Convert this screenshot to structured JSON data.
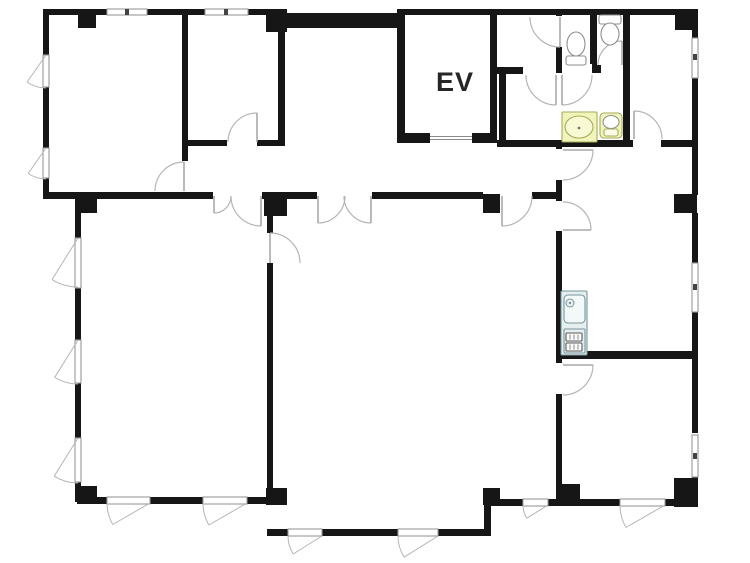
{
  "label": {
    "text": "EV"
  },
  "colors": {
    "background": "#ffffff",
    "wall": "#161616",
    "arc": "#b5b5b5",
    "leaf": "#a8a8a8",
    "glass": "#999999",
    "tick": "#444444",
    "fixture_stroke": "#8f8f8f",
    "fixture_fill": "#ffffff",
    "yellow_fill": "#f2f5ba",
    "yellow_stroke": "#a6aa5e",
    "yellow_bowl": "#f7fad2",
    "kitchen_fill": "#e6efef",
    "kitchen_stroke": "#76969c",
    "label": "#262626",
    "ev_door": "#8a8a8a"
  },
  "walls": [
    [
      43,
      9,
      64,
      6
    ],
    [
      147,
      9,
      40,
      6
    ],
    [
      43,
      9,
      6,
      46
    ],
    [
      43,
      87,
      6,
      61
    ],
    [
      43,
      178,
      6,
      19
    ],
    [
      182,
      9,
      6,
      152
    ],
    [
      187,
      9,
      18,
      6
    ],
    [
      248,
      9,
      22,
      6
    ],
    [
      283,
      13,
      122,
      15
    ],
    [
      278,
      28,
      7,
      117
    ],
    [
      187,
      140,
      40,
      6
    ],
    [
      257,
      140,
      28,
      6
    ],
    [
      397,
      9,
      95,
      6
    ],
    [
      397,
      13,
      8,
      130
    ],
    [
      490,
      9,
      7,
      134
    ],
    [
      397,
      133,
      33,
      10
    ],
    [
      472,
      133,
      25,
      10
    ],
    [
      490,
      9,
      207,
      6
    ],
    [
      499,
      67,
      7,
      76
    ],
    [
      490,
      67,
      33,
      7
    ],
    [
      556,
      9,
      6,
      7
    ],
    [
      556,
      47,
      6,
      20
    ],
    [
      590,
      15,
      7,
      50
    ],
    [
      623,
      15,
      7,
      128
    ],
    [
      556,
      65,
      6,
      8
    ],
    [
      592,
      65,
      9,
      8
    ],
    [
      623,
      65,
      7,
      8
    ],
    [
      497,
      140,
      133,
      7
    ],
    [
      630,
      140,
      3,
      7
    ],
    [
      661,
      140,
      36,
      7
    ],
    [
      692,
      9,
      6,
      29
    ],
    [
      692,
      78,
      6,
      117
    ],
    [
      692,
      213,
      6,
      50
    ],
    [
      692,
      312,
      6,
      121
    ],
    [
      692,
      477,
      6,
      30
    ],
    [
      43,
      192,
      170,
      7
    ],
    [
      262,
      192,
      55,
      7
    ],
    [
      372,
      192,
      111,
      7
    ],
    [
      532,
      192,
      30,
      7
    ],
    [
      556,
      143,
      6,
      7
    ],
    [
      556,
      180,
      6,
      21
    ],
    [
      556,
      231,
      6,
      133
    ],
    [
      556,
      394,
      6,
      107
    ],
    [
      562,
      351,
      130,
      8
    ],
    [
      75,
      197,
      6,
      41
    ],
    [
      75,
      288,
      6,
      52
    ],
    [
      75,
      383,
      6,
      55
    ],
    [
      75,
      482,
      6,
      20
    ],
    [
      77,
      497,
      30,
      7
    ],
    [
      150,
      497,
      53,
      7
    ],
    [
      247,
      497,
      23,
      7
    ],
    [
      267,
      213,
      6,
      20
    ],
    [
      267,
      263,
      6,
      238
    ],
    [
      267,
      529,
      21,
      7
    ],
    [
      322,
      529,
      76,
      7
    ],
    [
      438,
      529,
      53,
      7
    ],
    [
      484,
      504,
      7,
      30
    ],
    [
      491,
      499,
      32,
      7
    ],
    [
      548,
      499,
      72,
      7
    ],
    [
      665,
      499,
      32,
      7
    ]
  ],
  "pillars": [
    [
      78,
      9,
      18,
      19
    ],
    [
      266,
      9,
      21,
      23
    ],
    [
      675,
      12,
      22,
      18
    ],
    [
      77,
      197,
      20,
      16
    ],
    [
      264,
      194,
      23,
      22
    ],
    [
      483,
      194,
      17,
      19
    ],
    [
      674,
      194,
      23,
      19
    ],
    [
      77,
      486,
      20,
      18
    ],
    [
      266,
      488,
      21,
      17
    ],
    [
      483,
      488,
      17,
      17
    ],
    [
      560,
      484,
      20,
      17
    ],
    [
      674,
      478,
      23,
      29
    ]
  ],
  "openings": [
    [
      181,
      161,
      8,
      30
    ],
    [
      227,
      139,
      30,
      7
    ],
    [
      555,
      16,
      8,
      31
    ],
    [
      523,
      66,
      33,
      9
    ],
    [
      562,
      64,
      30,
      10
    ],
    [
      601,
      64,
      22,
      10
    ],
    [
      633,
      139,
      28,
      9
    ],
    [
      500,
      192,
      32,
      7
    ],
    [
      317,
      192,
      55,
      7
    ],
    [
      213,
      192,
      49,
      7
    ],
    [
      266,
      233,
      8,
      30
    ],
    [
      555,
      149,
      8,
      31
    ],
    [
      555,
      201,
      8,
      30
    ],
    [
      555,
      363,
      8,
      31
    ]
  ],
  "glass": [
    [
      107,
      9,
      40,
      6
    ],
    [
      205,
      9,
      43,
      6
    ],
    [
      692,
      38,
      6,
      40
    ],
    [
      692,
      263,
      6,
      49
    ],
    [
      692,
      435,
      6,
      42
    ],
    [
      43,
      55,
      6,
      32
    ],
    [
      43,
      148,
      6,
      30
    ],
    [
      75,
      238,
      6,
      50
    ],
    [
      75,
      340,
      6,
      43
    ],
    [
      75,
      438,
      6,
      44
    ],
    [
      107,
      497,
      43,
      7
    ],
    [
      203,
      497,
      44,
      7
    ],
    [
      288,
      529,
      34,
      7
    ],
    [
      398,
      529,
      40,
      7
    ],
    [
      523,
      499,
      25,
      7
    ],
    [
      620,
      499,
      45,
      7
    ]
  ],
  "ticks": [
    [
      127,
      12
    ],
    [
      226,
      12
    ],
    [
      695,
      57
    ],
    [
      695,
      287
    ],
    [
      695,
      456
    ]
  ],
  "doors": [
    {
      "h": [
        184,
        191
      ],
      "r": 29,
      "a0": 270,
      "a1": 180,
      "s": 0
    },
    {
      "h": [
        257,
        142
      ],
      "r": 29,
      "a0": 270,
      "a1": 180,
      "s": 0
    },
    {
      "h": [
        560,
        17
      ],
      "r": 30,
      "a0": 90,
      "a1": 180,
      "s": 1
    },
    {
      "h": [
        556,
        75
      ],
      "r": 30,
      "a0": 90,
      "a1": 180,
      "s": 1
    },
    {
      "h": [
        562,
        75
      ],
      "r": 30,
      "a0": 90,
      "a1": 0,
      "s": 0
    },
    {
      "h": [
        622,
        65
      ],
      "r": 24,
      "a0": 270,
      "a1": 180,
      "s": 0
    },
    {
      "h": [
        634,
        139
      ],
      "r": 28,
      "a0": 270,
      "a1": 360,
      "s": 1
    },
    {
      "h": [
        502,
        196
      ],
      "r": 30,
      "a0": 90,
      "a1": 0,
      "s": 0
    },
    {
      "h": [
        318,
        196
      ],
      "r": 27,
      "a0": 90,
      "a1": 0,
      "s": 0
    },
    {
      "h": [
        371,
        196
      ],
      "r": 27,
      "a0": 90,
      "a1": 180,
      "s": 1
    },
    {
      "h": [
        214,
        196
      ],
      "r": 17,
      "a0": 90,
      "a1": 0,
      "s": 0
    },
    {
      "h": [
        261,
        196
      ],
      "r": 30,
      "a0": 90,
      "a1": 180,
      "s": 1
    },
    {
      "h": [
        270,
        263
      ],
      "r": 30,
      "a0": 270,
      "a1": 360,
      "s": 1
    },
    {
      "h": [
        563,
        150
      ],
      "r": 30,
      "a0": 0,
      "a1": 90,
      "s": 1
    },
    {
      "h": [
        563,
        230
      ],
      "r": 28,
      "a0": 0,
      "a1": 270,
      "s": 0
    },
    {
      "h": [
        563,
        365
      ],
      "r": 30,
      "a0": 0,
      "a1": 90,
      "s": 1
    }
  ],
  "fans": [
    {
      "p": [
        46,
        55
      ],
      "len": 33,
      "a0": 90,
      "a1": 125,
      "s": 1
    },
    {
      "p": [
        46,
        148
      ],
      "len": 31,
      "a0": 90,
      "a1": 125,
      "s": 1
    },
    {
      "p": [
        78,
        238
      ],
      "len": 49,
      "a0": 90,
      "a1": 122,
      "s": 1
    },
    {
      "p": [
        78,
        340
      ],
      "len": 44,
      "a0": 90,
      "a1": 122,
      "s": 1
    },
    {
      "p": [
        78,
        438
      ],
      "len": 45,
      "a0": 90,
      "a1": 122,
      "s": 1
    },
    {
      "p": [
        150,
        503
      ],
      "len": 43,
      "a0": 180,
      "a1": 150,
      "s": 0
    },
    {
      "p": [
        247,
        503
      ],
      "len": 44,
      "a0": 180,
      "a1": 150,
      "s": 0
    },
    {
      "p": [
        548,
        505
      ],
      "len": 25,
      "a0": 180,
      "a1": 148,
      "s": 0
    },
    {
      "p": [
        665,
        505
      ],
      "len": 45,
      "a0": 180,
      "a1": 150,
      "s": 0
    },
    {
      "p": [
        322,
        536
      ],
      "len": 34,
      "a0": 180,
      "a1": 148,
      "s": 0
    },
    {
      "p": [
        438,
        536
      ],
      "len": 40,
      "a0": 180,
      "a1": 148,
      "s": 0
    }
  ],
  "ev_door": {
    "x": 430,
    "y": 134,
    "w": 42,
    "h": 8
  },
  "fixtures": {
    "toilet_left": {
      "base": [
        566,
        56,
        20,
        9
      ],
      "bowl": [
        576,
        44,
        9,
        12
      ]
    },
    "toilet_right": {
      "base": [
        599,
        15,
        22,
        9
      ],
      "bowl": [
        610,
        34,
        9,
        11
      ]
    },
    "vanity": {
      "counter": [
        562,
        112,
        35,
        30
      ],
      "oval": [
        579,
        127,
        14,
        11
      ],
      "dot": [
        579,
        128
      ]
    },
    "hand_basin": {
      "body": [
        600,
        113,
        22,
        25
      ],
      "oval": [
        611,
        122,
        8,
        6.5
      ],
      "tray": [
        604,
        129,
        14,
        7
      ]
    },
    "kitchenette": {
      "body": [
        561,
        291,
        26,
        64
      ],
      "sink": [
        564,
        295,
        21,
        28
      ],
      "faucet": [
        570,
        303,
        4
      ],
      "stove": [
        564,
        329,
        21,
        24
      ],
      "grill_a": [
        566,
        333,
        16,
        8
      ],
      "grill_b": [
        566,
        343,
        16,
        8
      ]
    }
  }
}
